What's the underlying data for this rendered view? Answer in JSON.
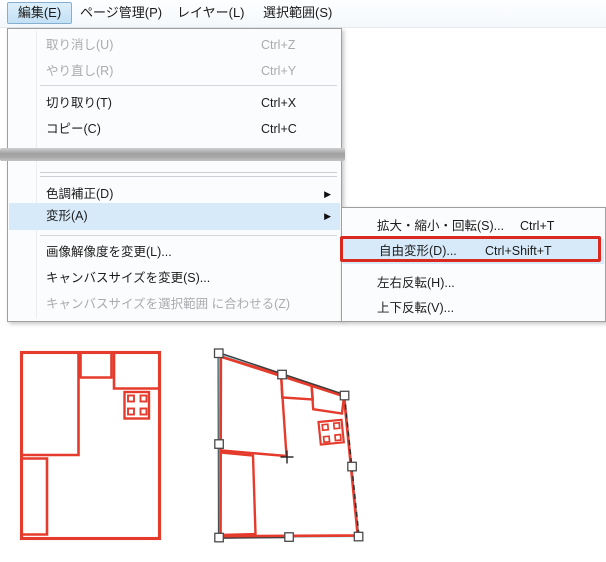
{
  "menubar": {
    "items": [
      {
        "label": "編集(E)",
        "active": true
      },
      {
        "label": "ページ管理(P)"
      },
      {
        "label": "レイヤー(L)"
      },
      {
        "label": "選択範囲(S)"
      }
    ]
  },
  "edit_menu": {
    "items": [
      {
        "label": "取り消し(U)",
        "shortcut": "Ctrl+Z",
        "disabled": true
      },
      {
        "label": "やり直し(R)",
        "shortcut": "Ctrl+Y",
        "disabled": true
      },
      {
        "label": "切り取り(T)",
        "shortcut": "Ctrl+X",
        "disabled": false
      },
      {
        "label": "コピー(C)",
        "shortcut": "Ctrl+C",
        "disabled": false
      },
      {
        "label": "色調補正(D)",
        "has_submenu": true,
        "disabled": false
      },
      {
        "label": "変形(A)",
        "has_submenu": true,
        "highlighted": true,
        "disabled": false
      },
      {
        "label": "画像解像度を変更(L)...",
        "disabled": false
      },
      {
        "label": "キャンバスサイズを変更(S)...",
        "disabled": false
      },
      {
        "label": "キャンバスサイズを選択範囲 に合わせる(Z)",
        "disabled": true
      }
    ]
  },
  "transform_submenu": {
    "items": [
      {
        "label": "拡大・縮小・回転(S)...",
        "shortcut": "Ctrl+T"
      },
      {
        "label": "自由変形(D)...",
        "shortcut": "Ctrl+Shift+T",
        "highlighted": true,
        "annotated_red_box": true
      },
      {
        "label": "左右反転(H)..."
      },
      {
        "label": "上下反転(V)..."
      }
    ]
  },
  "glyphs": {
    "submenu_arrow": "▶"
  },
  "colors": {
    "menu_highlight": "#d7eafa",
    "menubar_active_bg": "#c3e0f5",
    "menubar_active_border": "#86aed1",
    "annotation_red": "#da2a20",
    "drawing_red": "#e53b2c",
    "transform_frame_cyan": "#8fdbe9",
    "transform_frame_dark": "#3c3c3c",
    "disabled_text": "#a9abae",
    "splice_bar_gray": "#a8a8a8"
  }
}
